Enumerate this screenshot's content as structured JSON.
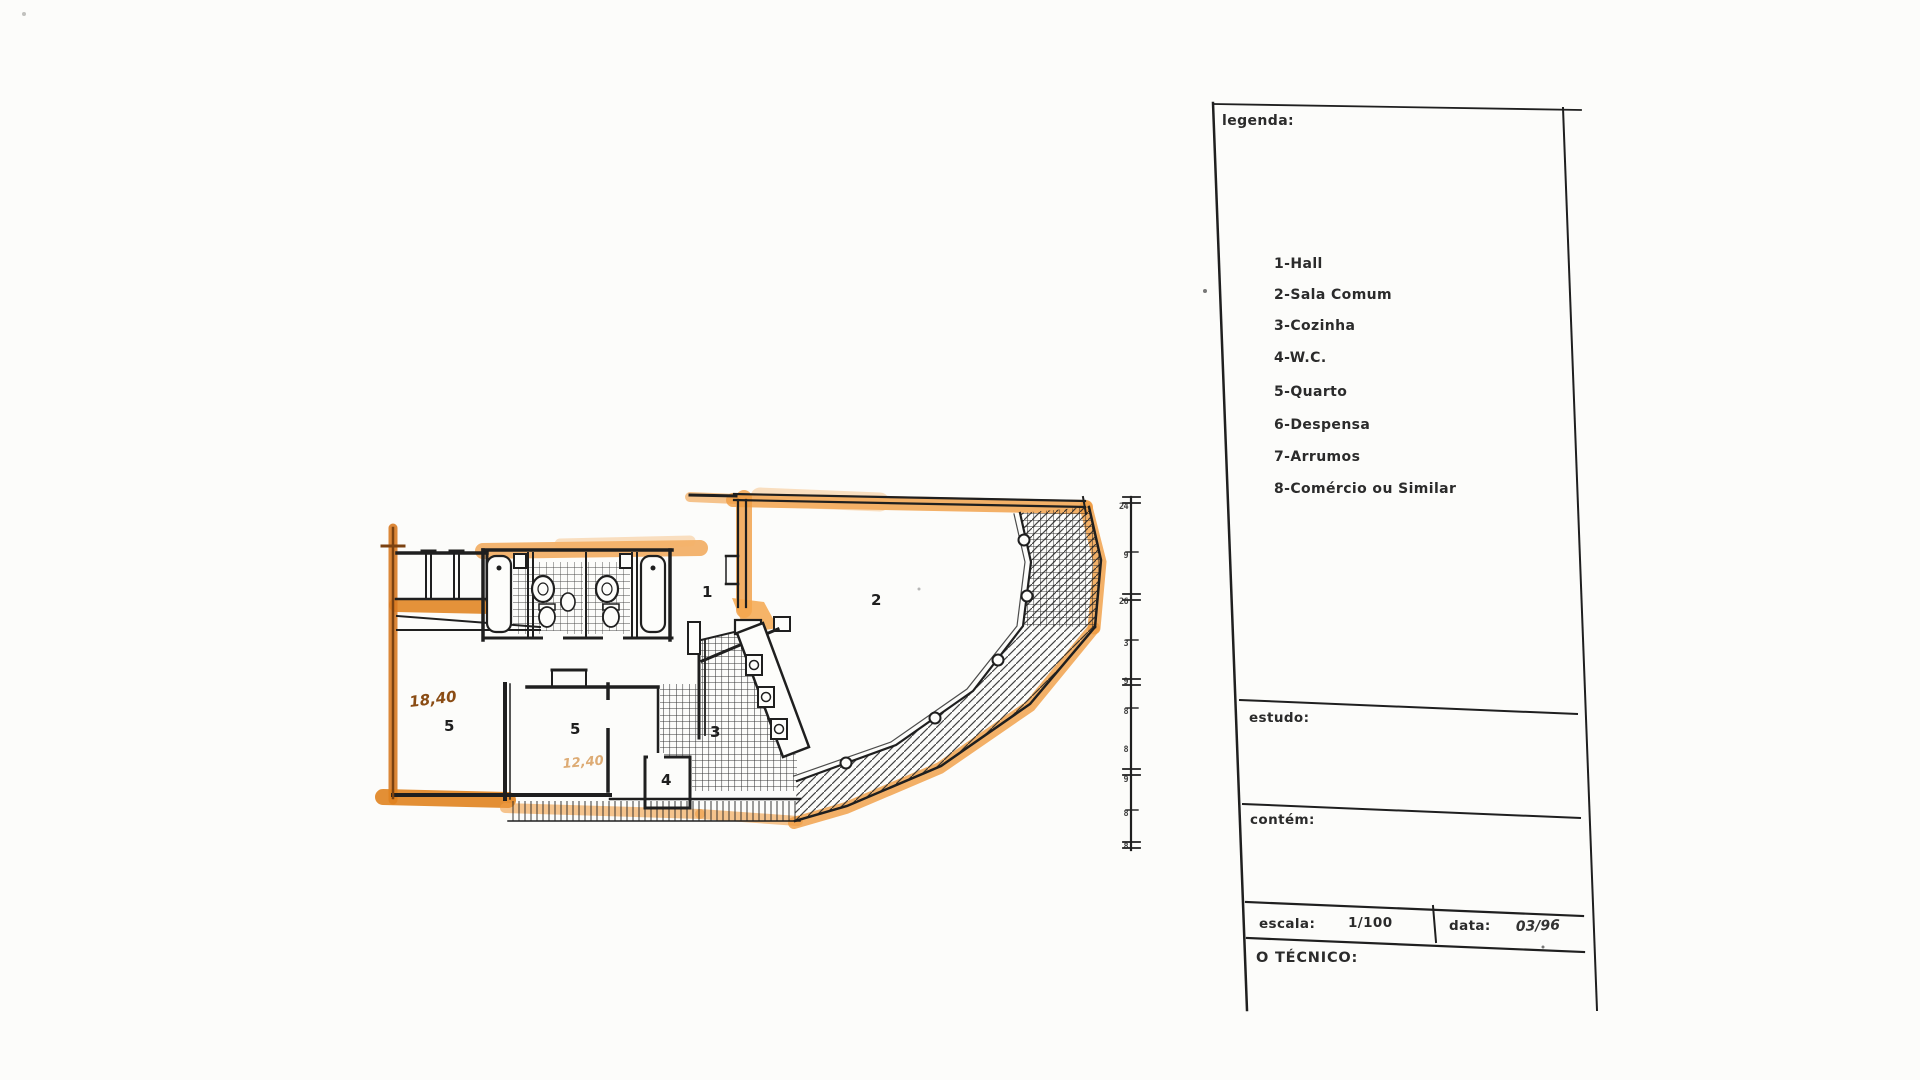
{
  "legend": {
    "title": "legenda:",
    "items": [
      "1-Hall",
      "2-Sala Comum",
      "3-Cozinha",
      "4-W.C.",
      "5-Quarto",
      "6-Despensa",
      "7-Arrumos",
      "8-Comércio ou Similar"
    ]
  },
  "title_block": {
    "estudo_label": "estudo:",
    "contem_label": "contém:",
    "escala_label": "escala:",
    "escala_value": "1/100",
    "data_label": "data:",
    "data_value": "03/96",
    "tecnico_label": "O TÉCNICO:"
  },
  "plan": {
    "rooms": [
      {
        "label": "1"
      },
      {
        "label": "2"
      },
      {
        "label": "3"
      },
      {
        "label": "4"
      },
      {
        "label": "5"
      },
      {
        "label": "5"
      }
    ],
    "annotations": {
      "area_bedroom1": "18,40",
      "area_bedroom2": "12,40"
    },
    "ruler_ticks": [
      "24",
      "9",
      "26",
      "3",
      "9",
      "8",
      "8",
      "9",
      "8",
      "8"
    ],
    "colors": {
      "highlight_orange": "#f09c42",
      "deep_orange": "#d87a22",
      "wall_ink": "#1f1f1f",
      "burnt_orange": "#8a4c14"
    }
  }
}
